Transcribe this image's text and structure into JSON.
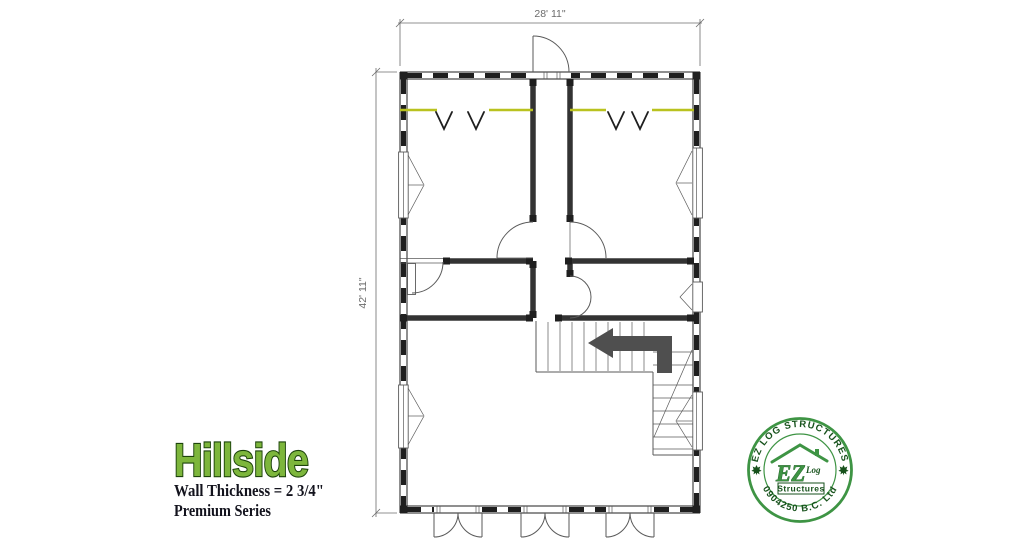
{
  "theme": {
    "paper": "#ffffff",
    "ink": "#1f1f1f",
    "wall": "#333333",
    "thin": "#5a5a5a",
    "dim": "#6b6b6b",
    "rod": "#b9c21f",
    "arrow": "#4f4f4f",
    "brand_green": "#3e9444",
    "brand_dark": "#17521c",
    "title_fill": "#7db63c",
    "title_stroke": "#1c430b",
    "text_dark": "#13131d"
  },
  "dimensions": {
    "width": "28' 11\"",
    "height": "42' 11\""
  },
  "title_block": {
    "model_name": "Hillside",
    "wall_thickness": "Wall Thickness = 2 3/4\"",
    "series": "Premium Series"
  },
  "stamp": {
    "arc_top": "EZ LOG STRUCTURES",
    "arc_bottom": "0904250 B.C. Ltd",
    "monogram": "EZ",
    "monogram_sub": "Log",
    "monogram_box": "Structures"
  }
}
